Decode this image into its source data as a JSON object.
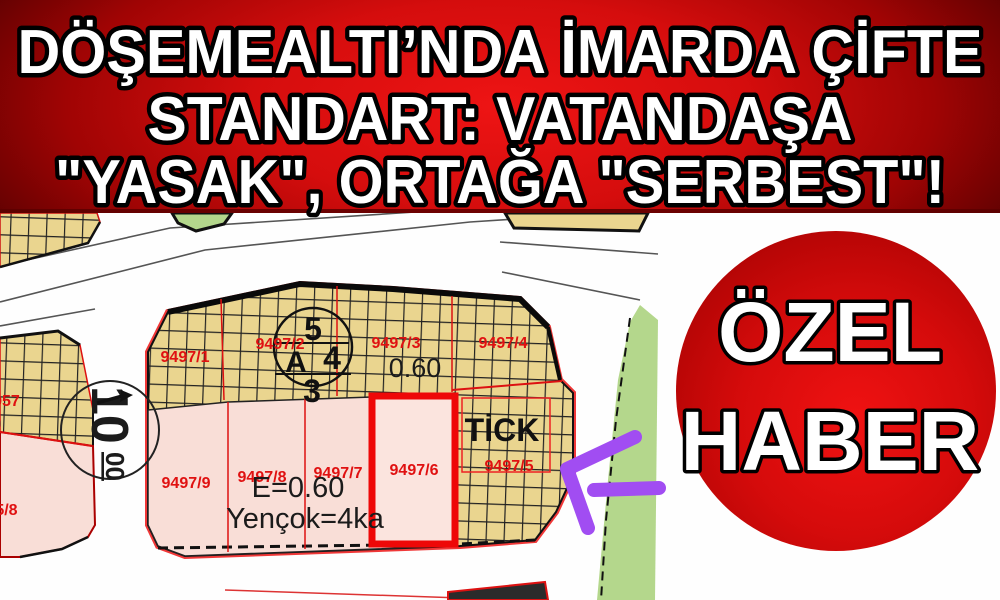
{
  "headline": {
    "line1": "DÖŞEMEALTI’NDA İMARDA ÇİFTE",
    "line2": "STANDART: VATANDAŞA",
    "line3": "\"YASAK\", ORTAĞA \"SERBEST\"!"
  },
  "badge": {
    "line1": "ÖZEL",
    "line2": "HABER"
  },
  "map": {
    "parcel_labels": {
      "p9497_1": "9497/1",
      "p9497_2": "9497/2",
      "p9497_3": "9497/3",
      "p9497_4": "9497/4",
      "p9497_5": "9497/5",
      "p9497_6": "9497/6",
      "p9497_7": "9497/7",
      "p9497_8": "9497/8",
      "p9497_9": "9497/9",
      "p9957": "9957",
      "p9495_8": "95/8"
    },
    "annotations": {
      "far_top": "0.60",
      "far_left": "0.60",
      "far_formula": "E=0.60",
      "height_formula": "Yençok=4ka",
      "zone_code": "TİCK",
      "road_width_main": "10",
      "road_width_sup": "00",
      "plan_circle_top": "5",
      "plan_circle_letter": "A",
      "plan_circle_right": "4",
      "plan_circle_bottom": "3"
    }
  },
  "colors": {
    "banner_red": "#d50d0d",
    "badge_red": "#d50b0b",
    "parcel_tan": "#ead58f",
    "parcel_pink": "#f9ded7",
    "highlight_pink": "#fbe4de",
    "park_green": "#b4d78c",
    "highlight_border_red": "#ee0808",
    "label_red": "#e01111",
    "arrow_purple": "#a14df2"
  }
}
